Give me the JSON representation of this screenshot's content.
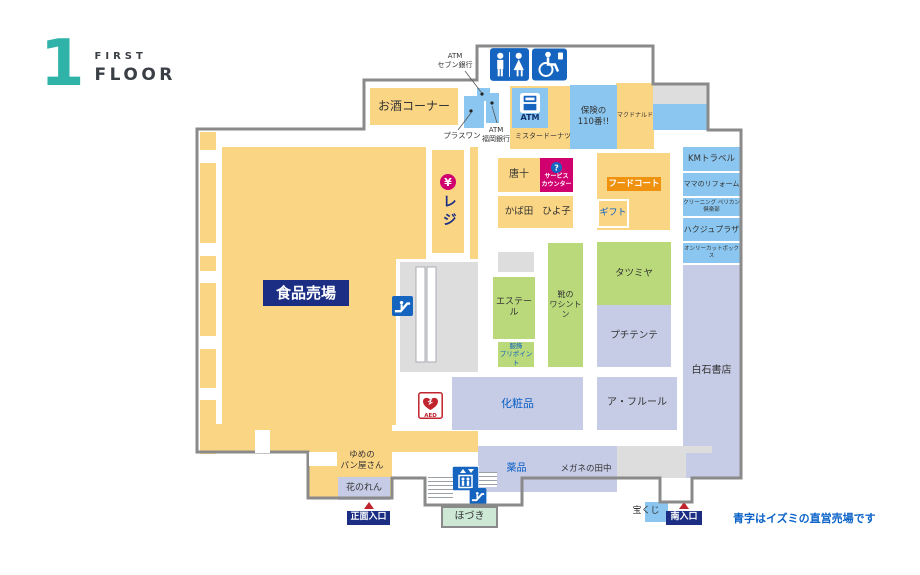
{
  "logo": {
    "number": "1",
    "line1": "FIRST",
    "line2": "FLOOR"
  },
  "note": {
    "text": "青字はイズミの直営売場です"
  },
  "colors": {
    "yellow": "#FAD584",
    "green": "#B9D97B",
    "lavender": "#C6CBE6",
    "blue": "#8AC6EF",
    "paleGreen": "#CDE9D6",
    "gray": "#DDDDDD",
    "navy": "#1B2E83",
    "magenta": "#D0006F",
    "orange": "#EF9210",
    "iconBlue": "#1565C0",
    "wall": "#8A8A8A",
    "red": "#C0242C",
    "textBlue": "#0A5FC4",
    "teal": "#2FB3A8",
    "dark": "#333333"
  },
  "map": {
    "areas": [
      {
        "id": "food-left-strip",
        "x": 200,
        "y": 132,
        "w": 16,
        "h": 322,
        "bg": "yellow"
      },
      {
        "id": "food-main",
        "x": 222,
        "y": 147,
        "w": 256,
        "h": 278,
        "bg": "yellow"
      },
      {
        "id": "register-channel",
        "x": 426,
        "y": 147,
        "w": 44,
        "h": 112,
        "bg": "#FFFFFF"
      },
      {
        "id": "escalator-court",
        "x": 396,
        "y": 259,
        "w": 84,
        "h": 170,
        "bg": "#FFFFFF"
      },
      {
        "id": "food-bottom-strip",
        "x": 222,
        "y": 431,
        "w": 256,
        "h": 21,
        "bg": "yellow"
      },
      {
        "id": "bottom-left-a",
        "x": 200,
        "y": 424,
        "w": 192,
        "h": 28,
        "bg": "yellow"
      },
      {
        "id": "bottom-left-b",
        "x": 308,
        "y": 452,
        "w": 84,
        "h": 46,
        "bg": "yellow"
      },
      {
        "id": "mrdonut-block",
        "x": 510,
        "y": 85,
        "w": 124,
        "h": 64,
        "bg": "yellow"
      },
      {
        "id": "mcdonalds",
        "label": "マクドナルド",
        "x": 616,
        "y": 83,
        "w": 38,
        "h": 66,
        "bg": "yellow",
        "fs": 6
      },
      {
        "id": "alcohol-corner",
        "label": "お酒コーナー",
        "x": 370,
        "y": 88,
        "w": 88,
        "h": 37,
        "bg": "yellow",
        "fs": 12
      },
      {
        "id": "restroom-block",
        "x": 483,
        "y": 40,
        "w": 88,
        "h": 46,
        "bg": "#FFFFFF"
      },
      {
        "id": "hoken110",
        "label": "保険の\n110番!!",
        "x": 570,
        "y": 85,
        "w": 47,
        "h": 64,
        "bg": "blue",
        "fs": 8.5
      },
      {
        "id": "gray-top-right",
        "x": 653,
        "y": 85,
        "w": 54,
        "h": 19,
        "bg": "gray"
      },
      {
        "id": "blue-top-right",
        "x": 653,
        "y": 104,
        "w": 54,
        "h": 26,
        "bg": "blue"
      },
      {
        "id": "sevenbank-atm",
        "x": 477,
        "y": 88,
        "w": 13,
        "h": 13,
        "bg": "blue"
      },
      {
        "id": "plusone",
        "x": 464,
        "y": 96,
        "w": 20,
        "h": 32,
        "bg": "blue"
      },
      {
        "id": "fukuokabank-atm",
        "x": 486,
        "y": 93,
        "w": 13,
        "h": 30,
        "bg": "blue"
      },
      {
        "id": "mrdonut-label",
        "label": "ミスタードーナツ",
        "x": 512,
        "y": 128,
        "w": 62,
        "h": 16,
        "fs": 7
      },
      {
        "id": "register",
        "label": "レジ",
        "x": 432,
        "y": 150,
        "w": 32,
        "h": 103,
        "bg": "yellow",
        "fg": "navy",
        "fs": 14,
        "bold": true,
        "icon": "yen",
        "icw": 16,
        "ich": 16,
        "vertical": true
      },
      {
        "id": "karaju",
        "label": "唐十",
        "x": 498,
        "y": 158,
        "w": 42,
        "h": 34,
        "bg": "yellow",
        "fs": 10
      },
      {
        "id": "service-counter",
        "label": "サービス\nカウンター",
        "x": 540,
        "y": 158,
        "w": 33,
        "h": 34,
        "bg": "magenta",
        "fg": "#FFFFFF",
        "fs": 6,
        "bold": true,
        "icon": "question",
        "icw": 11,
        "ich": 11
      },
      {
        "id": "kabata",
        "label": "かば田",
        "x": 498,
        "y": 196,
        "w": 42,
        "h": 32,
        "bg": "yellow",
        "fs": 9.5
      },
      {
        "id": "hiyoko",
        "label": "ひよ子",
        "x": 540,
        "y": 196,
        "w": 33,
        "h": 32,
        "bg": "yellow",
        "fs": 9.5
      },
      {
        "id": "foodcourt-block",
        "x": 597,
        "y": 153,
        "w": 73,
        "h": 77,
        "bg": "yellow"
      },
      {
        "id": "foodcourt-badge",
        "label": "フードコート",
        "x": 607,
        "y": 177,
        "w": 54,
        "h": 14,
        "bg": "orange",
        "fg": "#FFFFFF",
        "fs": 8.5,
        "bold": true
      },
      {
        "id": "gift",
        "label": "ギフト",
        "x": 597,
        "y": 199,
        "w": 32,
        "h": 29,
        "bg": "yellow",
        "fg": "textBlue",
        "fs": 9,
        "border": "2px solid #FFFFFF"
      },
      {
        "id": "km-travel",
        "label": "KMトラベル",
        "x": 683,
        "y": 147,
        "w": 57,
        "h": 24,
        "bg": "blue",
        "fs": 8.5
      },
      {
        "id": "mama-reform",
        "label": "ママのリフォーム",
        "x": 683,
        "y": 173,
        "w": 57,
        "h": 23,
        "bg": "blue",
        "fs": 7
      },
      {
        "id": "cleaning-pelican",
        "label": "クリーニング ペリカン倶楽部",
        "x": 683,
        "y": 198,
        "w": 57,
        "h": 18,
        "bg": "blue",
        "fs": 5.5
      },
      {
        "id": "hakuju-plaza",
        "label": "ハクジュプラザ",
        "x": 683,
        "y": 218,
        "w": 57,
        "h": 23,
        "bg": "blue",
        "fs": 8
      },
      {
        "id": "only-cut-box",
        "label": "オンリーカットボックス",
        "x": 683,
        "y": 243,
        "w": 57,
        "h": 20,
        "bg": "blue",
        "fs": 5.5
      },
      {
        "id": "shiraishi-books",
        "label": "白石書店",
        "x": 683,
        "y": 265,
        "w": 57,
        "h": 213,
        "bg": "lavender",
        "fs": 10
      },
      {
        "id": "gray-small",
        "x": 498,
        "y": 252,
        "w": 36,
        "h": 20,
        "bg": "gray"
      },
      {
        "id": "escalator-block",
        "x": 400,
        "y": 262,
        "w": 78,
        "h": 110,
        "bg": "gray"
      },
      {
        "id": "estelle",
        "label": "エステール",
        "x": 493,
        "y": 277,
        "w": 42,
        "h": 62,
        "bg": "green",
        "fs": 9
      },
      {
        "id": "pripoint",
        "label": "服飾\nプリポイント",
        "x": 498,
        "y": 342,
        "w": 36,
        "h": 25,
        "bg": "green",
        "fg": "textBlue",
        "fs": 6.5
      },
      {
        "id": "washington-shoes",
        "label": "靴の\nワシントン",
        "x": 548,
        "y": 243,
        "w": 35,
        "h": 124,
        "bg": "green",
        "fs": 8
      },
      {
        "id": "tatsumiya",
        "label": "タツミヤ",
        "x": 597,
        "y": 242,
        "w": 74,
        "h": 63,
        "bg": "green",
        "fs": 9.5
      },
      {
        "id": "petit-tente",
        "label": "プチテンテ",
        "x": 597,
        "y": 305,
        "w": 74,
        "h": 62,
        "bg": "lavender",
        "fs": 9.5
      },
      {
        "id": "cosmetics",
        "label": "化粧品",
        "x": 452,
        "y": 377,
        "w": 131,
        "h": 53,
        "bg": "lavender",
        "fg": "textBlue",
        "fs": 11
      },
      {
        "id": "a-fleur",
        "label": "ア・フルール",
        "x": 597,
        "y": 377,
        "w": 80,
        "h": 53,
        "bg": "lavender",
        "fs": 10
      },
      {
        "id": "yakuhin",
        "label": "薬品",
        "x": 478,
        "y": 446,
        "w": 77,
        "h": 46,
        "bg": "lavender",
        "fg": "textBlue",
        "fs": 10
      },
      {
        "id": "megane-tanaka",
        "label": "メガネの田中",
        "x": 555,
        "y": 446,
        "w": 62,
        "h": 46,
        "bg": "lavender",
        "fs": 8.5
      },
      {
        "id": "gray-bottom-right",
        "x": 617,
        "y": 446,
        "w": 95,
        "h": 32,
        "bg": "gray"
      },
      {
        "id": "lavender-tongue",
        "x": 686,
        "y": 453,
        "w": 26,
        "h": 25,
        "bg": "lavender"
      },
      {
        "id": "yume-bakery",
        "label": "ゆめの\nパン屋さん",
        "x": 330,
        "y": 445,
        "w": 64,
        "h": 31,
        "fs": 8.5
      },
      {
        "id": "hana-noren",
        "label": "花のれん",
        "x": 338,
        "y": 477,
        "w": 52,
        "h": 23,
        "bg": "lavender",
        "fs": 9
      },
      {
        "id": "hozuki",
        "label": "ほづき",
        "x": 441,
        "y": 506,
        "w": 57,
        "h": 22,
        "bg": "paleGreen",
        "fs": 10,
        "border": "2px solid #8A8A8A"
      },
      {
        "id": "takarakuji-box",
        "x": 645,
        "y": 502,
        "w": 23,
        "h": 20,
        "bg": "blue"
      },
      {
        "id": "takarakuji-label",
        "label": "宝くじ",
        "x": 628,
        "y": 505,
        "w": 36,
        "h": 14,
        "fs": 9
      },
      {
        "id": "food-dept-label",
        "label": "食品売場",
        "x": 263,
        "y": 280,
        "w": 86,
        "h": 26,
        "bg": "navy",
        "fg": "#FFFFFF",
        "fs": 15,
        "bold": true
      },
      {
        "id": "atm-booth",
        "label": "ATM",
        "x": 512,
        "y": 88,
        "w": 36,
        "h": 40,
        "bg": "blue",
        "fg": "#12306B",
        "fs": 8,
        "bold": true,
        "icon": "atm",
        "icw": 20,
        "ich": 20
      },
      {
        "id": "restroom",
        "x": 490,
        "y": 48,
        "w": 39,
        "h": 33,
        "icon": "restroom",
        "icw": 39,
        "ich": 33
      },
      {
        "id": "accessible-restroom",
        "x": 532,
        "y": 48,
        "w": 35,
        "h": 33,
        "icon": "wheelchair",
        "icw": 35,
        "ich": 33
      },
      {
        "id": "escalator-mid",
        "x": 392,
        "y": 296,
        "w": 21,
        "h": 20,
        "icon": "escalator",
        "icw": 21,
        "ich": 20
      },
      {
        "id": "elevator",
        "x": 452,
        "y": 466,
        "w": 27,
        "h": 25,
        "icon": "elevator",
        "icw": 27,
        "ich": 25
      },
      {
        "id": "escalator-bottom",
        "x": 469,
        "y": 488,
        "w": 18,
        "h": 16,
        "icon": "escalator",
        "icw": 18,
        "ich": 16
      },
      {
        "id": "aed",
        "x": 418,
        "y": 392,
        "w": 25,
        "h": 27,
        "icon": "aed",
        "icw": 25,
        "ich": 27
      },
      {
        "id": "stairs-left",
        "x": 428,
        "y": 477,
        "w": 25,
        "h": 23,
        "stripes": true
      },
      {
        "id": "stairs-right",
        "x": 479,
        "y": 472,
        "w": 18,
        "h": 15,
        "stripes": true
      },
      {
        "id": "atm-seven-label",
        "label": "ATM\nセブン銀行",
        "x": 430,
        "y": 50,
        "w": 50,
        "h": 22,
        "fs": 7
      },
      {
        "id": "plusone-label",
        "label": "プラスワン",
        "x": 440,
        "y": 130,
        "w": 44,
        "h": 11,
        "fs": 7.5
      },
      {
        "id": "fukuoka-label",
        "label": "ATM\n福岡銀行",
        "x": 479,
        "y": 124,
        "w": 34,
        "h": 21,
        "fs": 7
      },
      {
        "id": "main-entrance",
        "label": "正面入口",
        "x": 347,
        "y": 511,
        "w": 43,
        "h": 14,
        "bg": "navy",
        "fg": "#FFFFFF",
        "fs": 9,
        "bold": true,
        "tri": true
      },
      {
        "id": "south-entrance",
        "label": "南入口",
        "x": 666,
        "y": 511,
        "w": 36,
        "h": 14,
        "bg": "navy",
        "fg": "#FFFFFF",
        "fs": 9,
        "bold": true,
        "tri": true
      }
    ]
  }
}
